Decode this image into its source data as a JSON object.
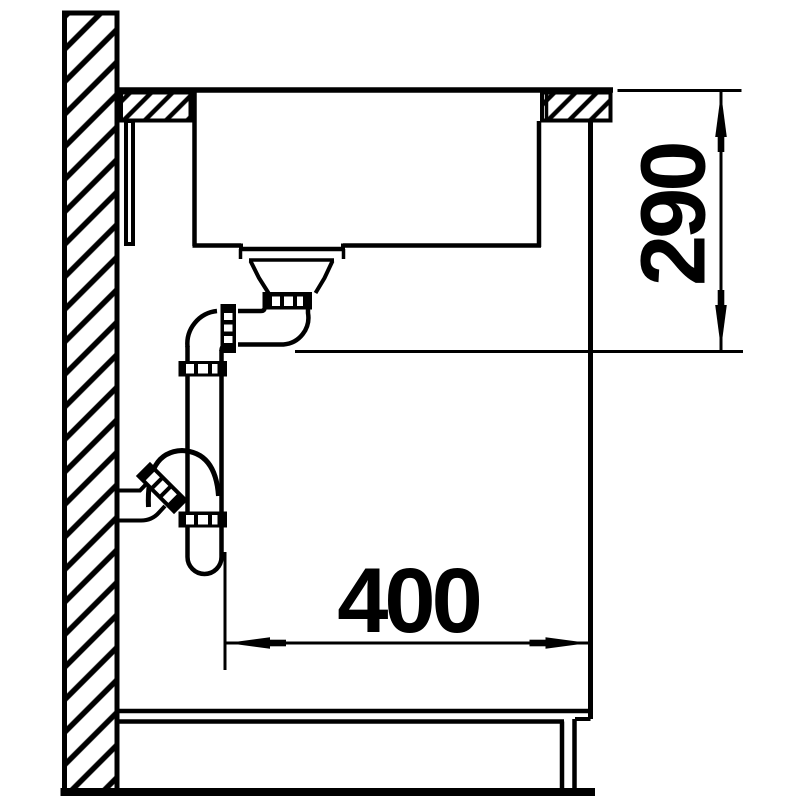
{
  "title": "Sink installation cross-section technical drawing",
  "colors": {
    "line": "#000000",
    "background": "#ffffff"
  },
  "dimensions": {
    "vertical": {
      "label": "290",
      "orientation": "vertical",
      "meaning": "depth from countertop surface to drain outlet"
    },
    "horizontal": {
      "label": "400",
      "orientation": "horizontal",
      "meaning": "distance from trap axis to cabinet front"
    }
  }
}
